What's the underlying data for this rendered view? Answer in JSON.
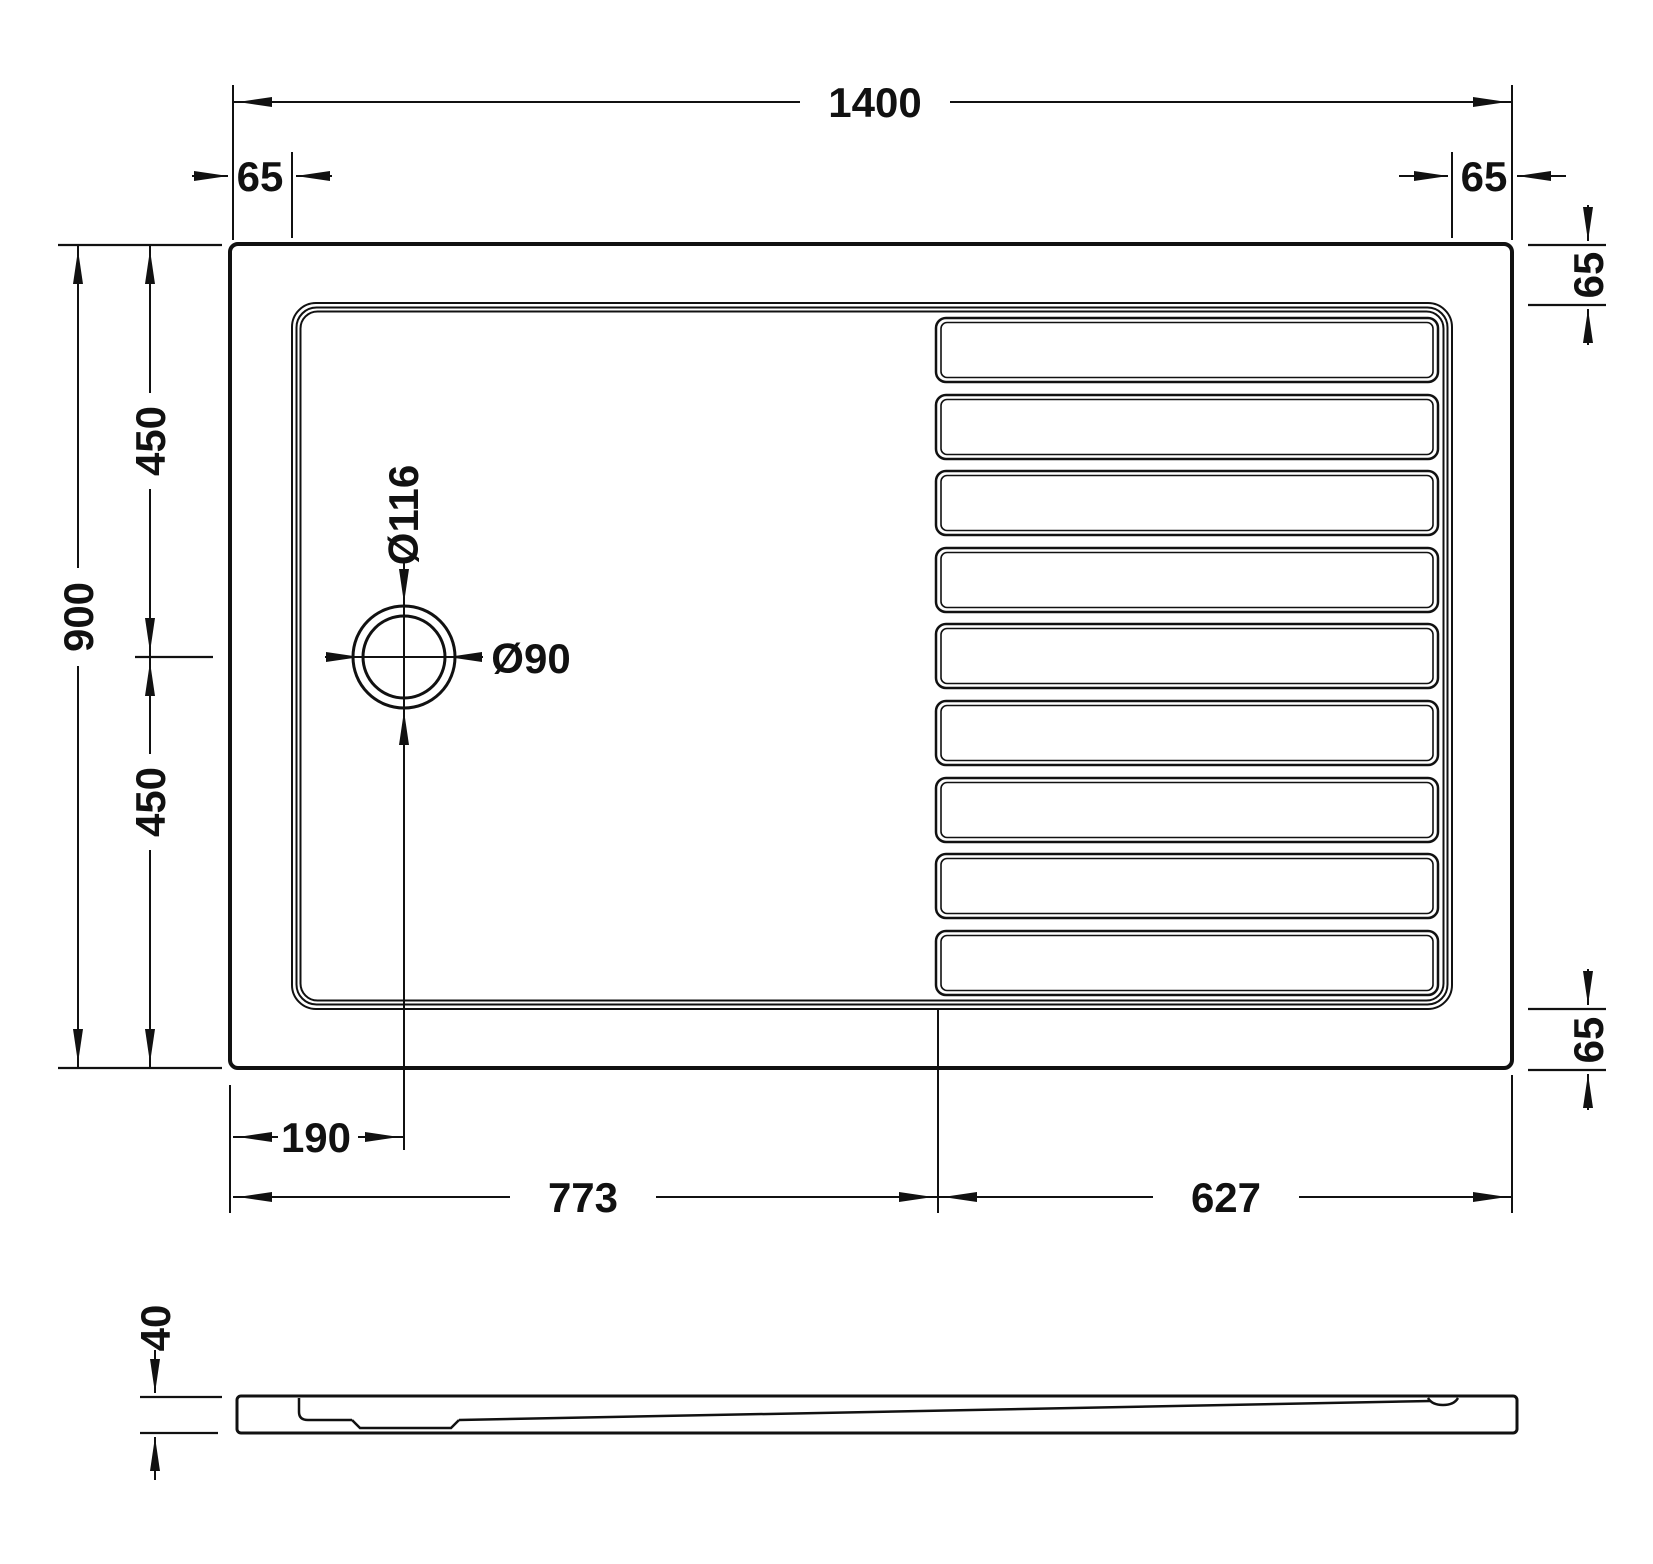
{
  "colors": {
    "line": "#111111",
    "background": "#ffffff"
  },
  "top_view": {
    "dims": {
      "width": "1400",
      "depth": "900",
      "depth_upper": "450",
      "depth_lower": "450",
      "rim_top_left": "65",
      "rim_top_right": "65",
      "rim_right_top": "65",
      "rim_right_bottom": "65",
      "drain_outer_dia": "Ø116",
      "drain_inner_dia": "Ø90",
      "drain_offset": "190",
      "smooth_zone": "773",
      "ridged_zone": "627"
    },
    "ridge_count": 9
  },
  "side_view": {
    "dims": {
      "height": "40"
    }
  }
}
